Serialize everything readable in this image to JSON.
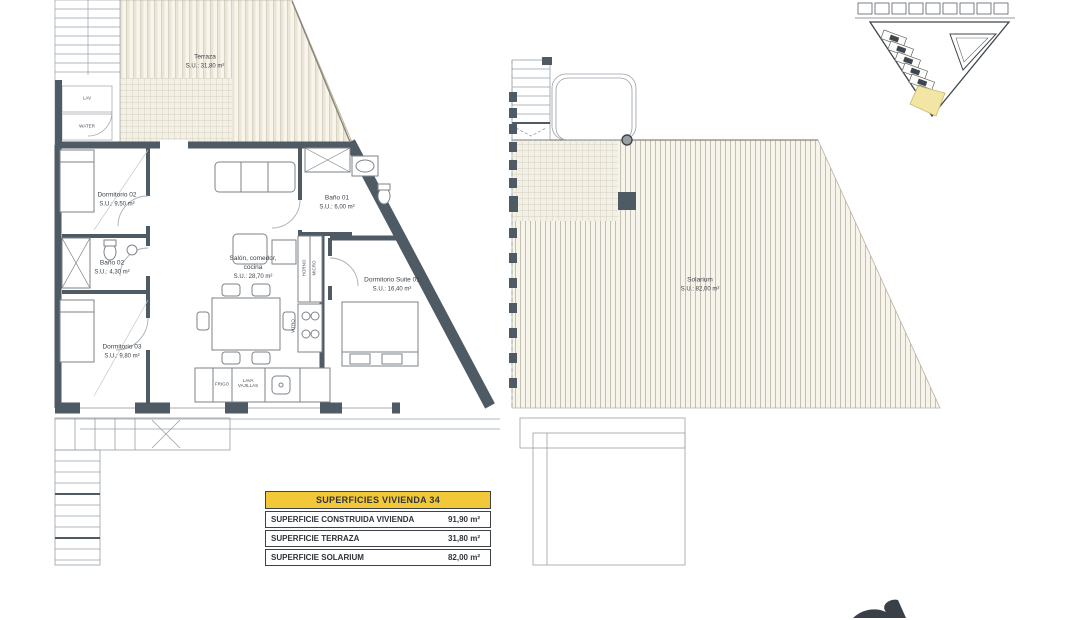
{
  "plan_left": {
    "rooms": [
      {
        "name": "Terraza",
        "area": "S.U.: 31,80 m²"
      },
      {
        "name": "Dormitorio 02",
        "area": "S.U.: 9,50 m²"
      },
      {
        "name": "Baño 02",
        "area": "S.U.: 4,30 m²"
      },
      {
        "name": "Dormitorio 03",
        "area": "S.U.: 9,80 m²"
      },
      {
        "name": "Salón, comedor, cocina",
        "area": "S.U.: 28,70 m²"
      },
      {
        "name": "Baño 01",
        "area": "S.U.: 6,00 m²"
      },
      {
        "name": "Dormitorio Suite 01",
        "area": "S.U.: 16,40 m²"
      }
    ],
    "appliance_labels": {
      "washer": "LAV",
      "water": "WATER",
      "fridge": "FRIGO",
      "dishwasher": "LAVA VAJILLAS",
      "oven": "HORNO",
      "micro": "MICRO",
      "hob": "VITRO"
    }
  },
  "plan_right": {
    "room": {
      "name": "Solarium",
      "area": "S.U.: 82,00 m²"
    }
  },
  "summary_table": {
    "title": "SUPERFICIES VIVIENDA 34",
    "rows": [
      {
        "label": "SUPERFICIE CONSTRUIDA VIVIENDA",
        "value": "91,90 m²"
      },
      {
        "label": "SUPERFICIE TERRAZA",
        "value": "31,80 m²"
      },
      {
        "label": "SUPERFICIE SOLARIUM",
        "value": "82,00 m²"
      }
    ]
  },
  "colors": {
    "wall": "#4e5a64",
    "table_header": "#f2c838",
    "site_highlight": "#f3e5a3",
    "hatch_beige": "#eae5d6"
  }
}
